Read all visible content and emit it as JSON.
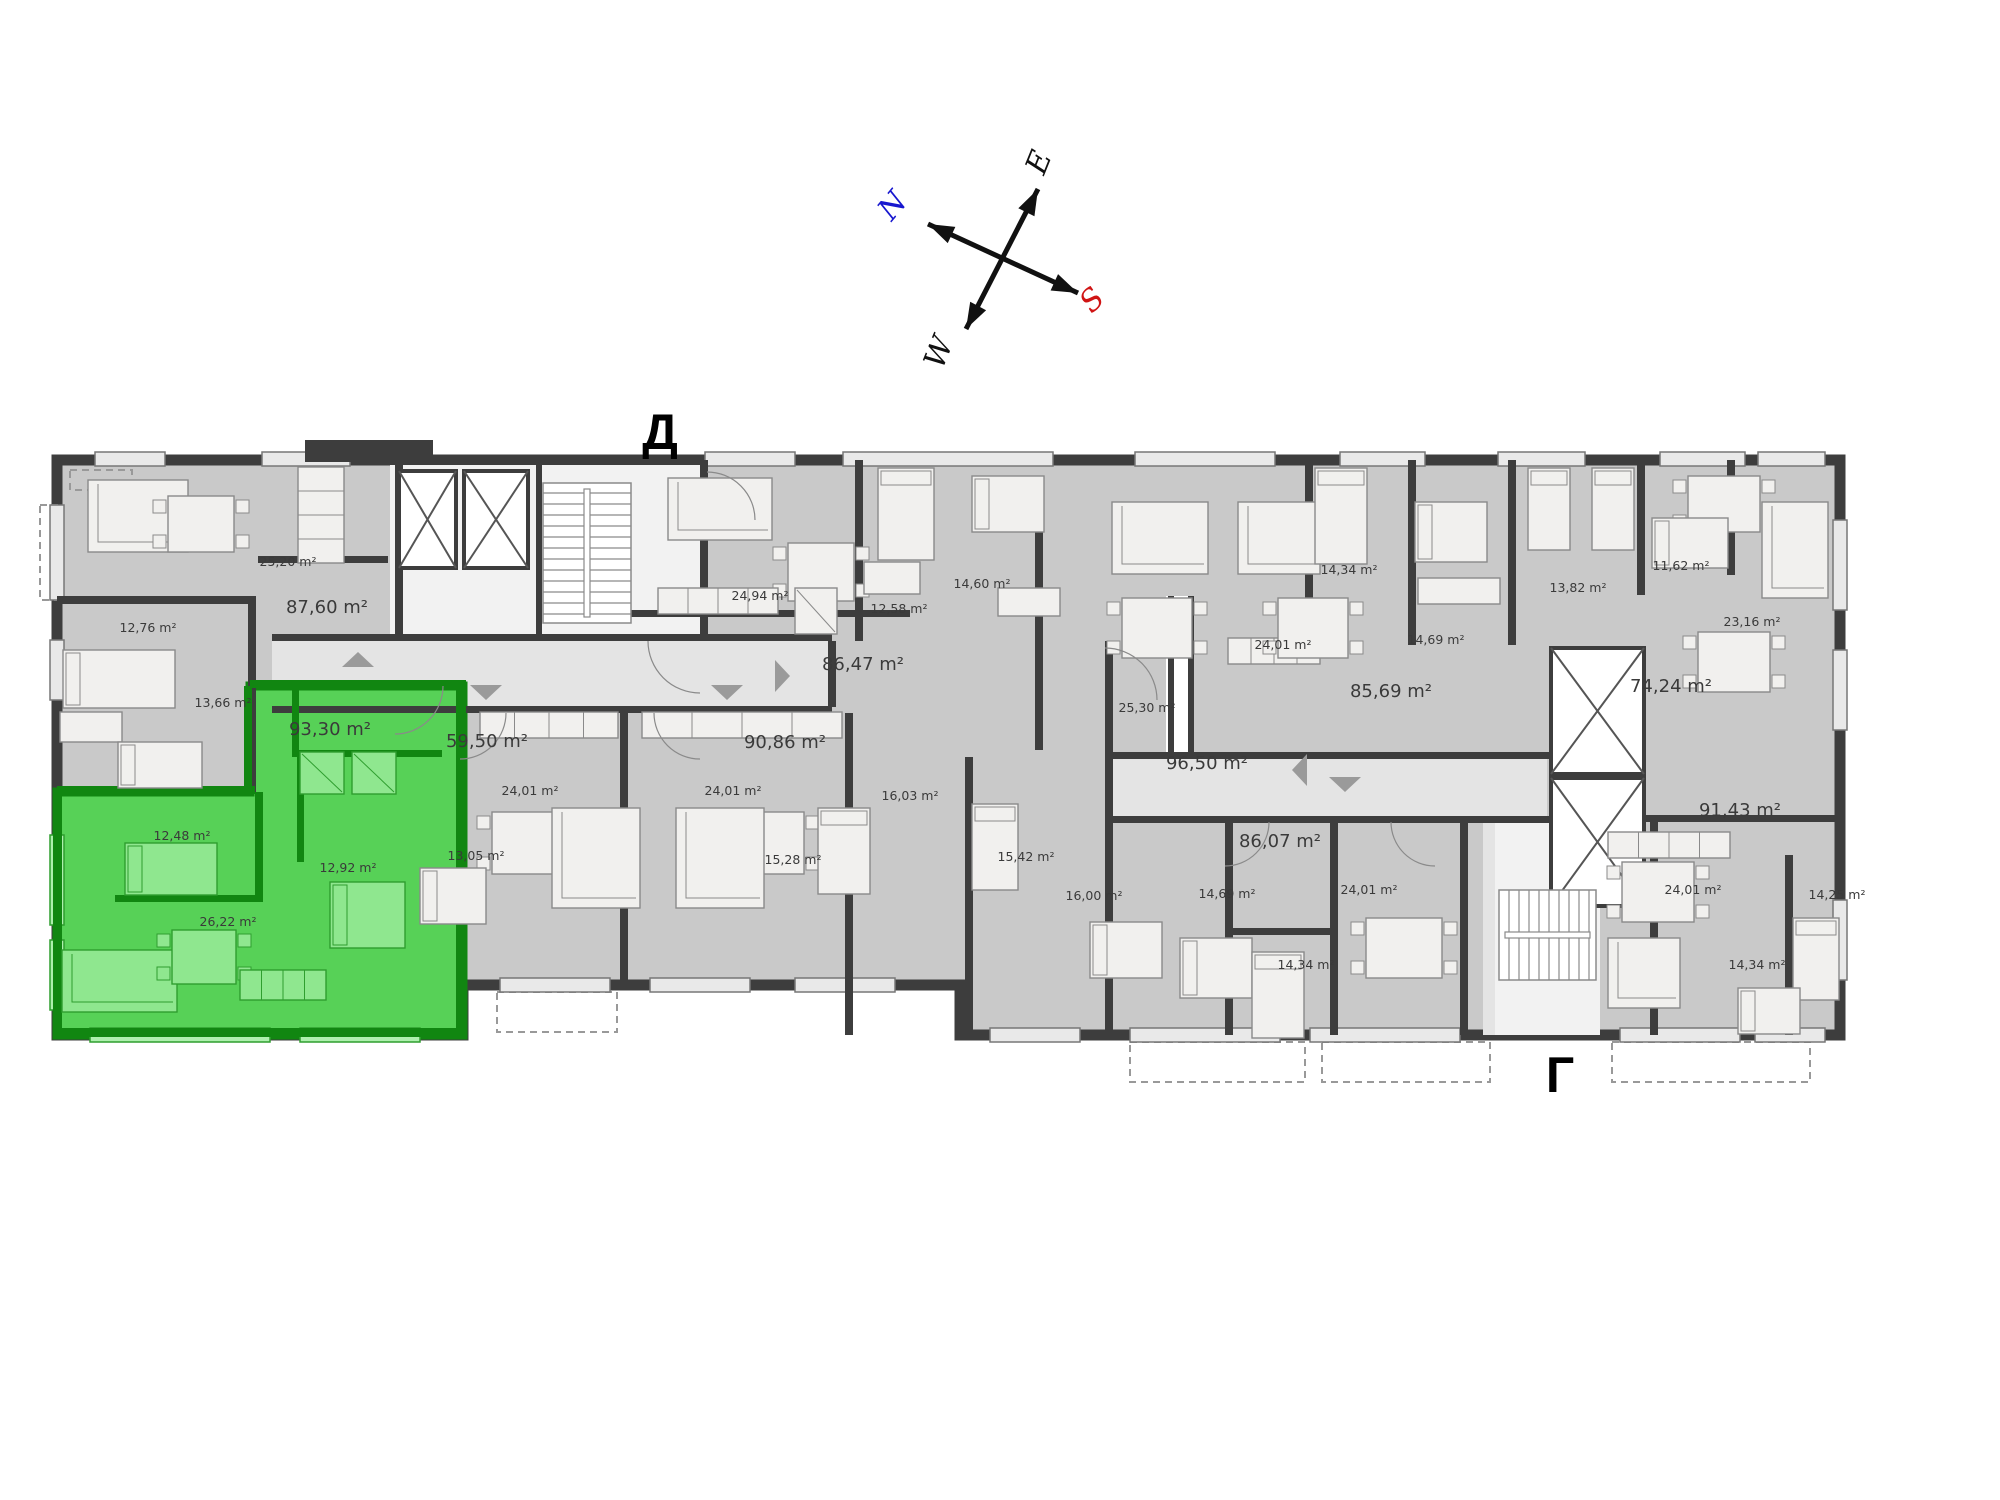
{
  "sections": {
    "d": "Д",
    "g": "Г"
  },
  "compass": {
    "center": [
      1003,
      259
    ],
    "lines": [
      [
        [
          928,
          224
        ],
        [
          1078,
          293
        ]
      ],
      [
        [
          1038,
          189
        ],
        [
          966,
          329
        ]
      ]
    ],
    "arms": [
      {
        "label": "N",
        "tip": [
          928,
          224
        ],
        "lx": 900,
        "ly": 212,
        "rot": -50,
        "color": "#1717cf"
      },
      {
        "label": "E",
        "tip": [
          1038,
          189
        ],
        "lx": 1048,
        "ly": 166,
        "rot": -68,
        "color": "#111111"
      },
      {
        "label": "S",
        "tip": [
          1078,
          293
        ],
        "lx": 1099,
        "ly": 307,
        "rot": -45,
        "color": "#d01414"
      },
      {
        "label": "W",
        "tip": [
          966,
          329
        ],
        "lx": 948,
        "ly": 356,
        "rot": -68,
        "color": "#111111"
      }
    ]
  },
  "palette": {
    "room": "#c9c9c9",
    "corridor": "#e4e4e4",
    "lobby": "#f2f2f2",
    "wall": "#3d3d3d",
    "window_fill": "#e9e9e9",
    "window_stroke": "#777777",
    "furn_fill": "#f1f0ee",
    "furn_stroke": "#8a8a8a",
    "green_fill": "#57d157",
    "green_wall": "#118611",
    "green_furn": "#8fe78f",
    "green_furn_stroke": "#2f9e2f",
    "green_window": "#aef0ae",
    "label": "#3a3a3a",
    "arrow": "#9a9a9a",
    "white": "#ffffff"
  },
  "plan": {
    "outline": [
      [
        57,
        460
      ],
      [
        1840,
        460
      ],
      [
        1840,
        1035
      ],
      [
        1105,
        1035
      ],
      [
        1105,
        1035
      ],
      [
        960,
        1035
      ],
      [
        960,
        985
      ],
      [
        463,
        985
      ],
      [
        463,
        1035
      ],
      [
        57,
        1035
      ]
    ],
    "corridors": [
      [
        272,
        641,
        558,
        66
      ],
      [
        1105,
        757,
        442,
        62
      ],
      [
        1483,
        819,
        64,
        216
      ]
    ],
    "lobbies": [
      [
        607,
        465,
        95,
        176
      ],
      [
        1495,
        822,
        105,
        213
      ],
      [
        390,
        465,
        250,
        176
      ]
    ],
    "seam": [
      1166,
      596,
      28,
      162
    ],
    "green_polygon": [
      [
        250,
        686
      ],
      [
        463,
        686
      ],
      [
        463,
        1035
      ],
      [
        57,
        1035
      ],
      [
        57,
        792
      ],
      [
        250,
        792
      ]
    ],
    "green_walls": [
      [
        250,
        680,
        216,
        8
      ],
      [
        57,
        786,
        198,
        8
      ],
      [
        244,
        686,
        8,
        106
      ],
      [
        456,
        686,
        10,
        349
      ],
      [
        292,
        686,
        7,
        70
      ],
      [
        292,
        750,
        150,
        7
      ],
      [
        255,
        792,
        8,
        110
      ],
      [
        115,
        895,
        148,
        7
      ],
      [
        297,
        757,
        7,
        105
      ],
      [
        53,
        792,
        9,
        243
      ],
      [
        53,
        1028,
        414,
        9
      ]
    ],
    "walls": [
      [
        248,
        596,
        8,
        196
      ],
      [
        395,
        460,
        8,
        181
      ],
      [
        536,
        460,
        6,
        181
      ],
      [
        700,
        460,
        8,
        181
      ],
      [
        855,
        460,
        8,
        181
      ],
      [
        1035,
        520,
        8,
        230
      ],
      [
        1105,
        641,
        8,
        394
      ],
      [
        1168,
        596,
        6,
        160
      ],
      [
        1188,
        596,
        6,
        160
      ],
      [
        1305,
        460,
        8,
        185
      ],
      [
        1408,
        460,
        8,
        185
      ],
      [
        1508,
        460,
        8,
        185
      ],
      [
        1637,
        460,
        8,
        135
      ],
      [
        1727,
        460,
        8,
        115
      ],
      [
        620,
        713,
        8,
        272
      ],
      [
        845,
        713,
        8,
        322
      ],
      [
        965,
        757,
        8,
        278
      ],
      [
        1225,
        822,
        8,
        213
      ],
      [
        1330,
        822,
        8,
        213
      ],
      [
        1460,
        822,
        8,
        213
      ],
      [
        1650,
        822,
        8,
        213
      ],
      [
        1785,
        855,
        8,
        180
      ],
      [
        57,
        596,
        195,
        8
      ],
      [
        258,
        556,
        130,
        7
      ],
      [
        272,
        634,
        560,
        7
      ],
      [
        272,
        706,
        560,
        7
      ],
      [
        828,
        641,
        8,
        66
      ],
      [
        630,
        610,
        280,
        7
      ],
      [
        1105,
        752,
        445,
        7
      ],
      [
        1105,
        816,
        445,
        7
      ],
      [
        1230,
        928,
        105,
        7
      ],
      [
        1645,
        815,
        195,
        7
      ],
      [
        305,
        440,
        128,
        22
      ]
    ],
    "windows": [
      [
        95,
        452,
        70,
        14
      ],
      [
        262,
        452,
        88,
        14
      ],
      [
        705,
        452,
        90,
        14
      ],
      [
        843,
        452,
        210,
        14
      ],
      [
        1135,
        452,
        140,
        14
      ],
      [
        1340,
        452,
        85,
        14
      ],
      [
        1498,
        452,
        87,
        14
      ],
      [
        1660,
        452,
        85,
        14
      ],
      [
        1758,
        452,
        67,
        14
      ],
      [
        50,
        505,
        14,
        95
      ],
      [
        50,
        640,
        14,
        60
      ],
      [
        500,
        978,
        110,
        14
      ],
      [
        650,
        978,
        100,
        14
      ],
      [
        795,
        978,
        100,
        14
      ],
      [
        990,
        1028,
        90,
        14
      ],
      [
        1130,
        1028,
        150,
        14
      ],
      [
        1310,
        1028,
        150,
        14
      ],
      [
        1620,
        1028,
        120,
        14
      ],
      [
        1755,
        1028,
        70,
        14
      ],
      [
        1833,
        520,
        14,
        90
      ],
      [
        1833,
        650,
        14,
        80
      ],
      [
        1833,
        900,
        14,
        80
      ]
    ],
    "green_windows": [
      [
        90,
        1028,
        180,
        14
      ],
      [
        300,
        1028,
        120,
        14
      ],
      [
        50,
        835,
        14,
        90
      ],
      [
        50,
        940,
        14,
        70
      ]
    ],
    "balconies": [
      [
        497,
        992,
        120,
        40
      ],
      [
        1130,
        1042,
        175,
        40
      ],
      [
        1322,
        1042,
        168,
        40
      ],
      [
        1612,
        1042,
        198,
        40
      ],
      [
        40,
        505,
        17,
        95
      ],
      [
        70,
        470,
        62,
        20
      ]
    ],
    "cores": [
      [
        399,
        471,
        57,
        97
      ],
      [
        464,
        471,
        64,
        97
      ],
      [
        1551,
        648,
        93,
        126
      ],
      [
        1551,
        778,
        93,
        128
      ]
    ],
    "stairs": [
      {
        "rect": [
          543,
          483,
          88,
          140
        ],
        "dir": "v"
      },
      {
        "rect": [
          1499,
          890,
          97,
          90
        ],
        "dir": "h"
      }
    ],
    "furniture": [
      {
        "k": "sofa",
        "r": [
          88,
          480,
          100,
          72
        ]
      },
      {
        "k": "table",
        "r": [
          168,
          496,
          66,
          56
        ]
      },
      {
        "k": "counter",
        "r": [
          298,
          467,
          46,
          96
        ]
      },
      {
        "k": "bed",
        "r": [
          63,
          650,
          112,
          58
        ]
      },
      {
        "k": "desk",
        "r": [
          60,
          712,
          62,
          30
        ]
      },
      {
        "k": "bed",
        "r": [
          118,
          742,
          84,
          46
        ]
      },
      {
        "k": "bed",
        "r": [
          125,
          843,
          92,
          52
        ],
        "g": 1
      },
      {
        "k": "bed",
        "r": [
          330,
          882,
          75,
          66
        ],
        "g": 1
      },
      {
        "k": "sofa",
        "r": [
          62,
          950,
          115,
          62
        ],
        "g": 1
      },
      {
        "k": "table",
        "r": [
          172,
          930,
          64,
          54
        ],
        "g": 1
      },
      {
        "k": "counter",
        "r": [
          240,
          970,
          86,
          30
        ],
        "g": 1
      },
      {
        "k": "shower",
        "r": [
          300,
          752,
          44,
          42
        ],
        "g": 1
      },
      {
        "k": "shower",
        "r": [
          352,
          752,
          44,
          42
        ],
        "g": 1
      },
      {
        "k": "sofa",
        "r": [
          668,
          478,
          104,
          62
        ]
      },
      {
        "k": "table",
        "r": [
          788,
          543,
          66,
          58
        ]
      },
      {
        "k": "counter",
        "r": [
          658,
          588,
          120,
          26
        ]
      },
      {
        "k": "bed",
        "r": [
          878,
          468,
          56,
          92
        ]
      },
      {
        "k": "desk",
        "r": [
          864,
          562,
          56,
          32
        ]
      },
      {
        "k": "bed",
        "r": [
          972,
          476,
          72,
          56
        ]
      },
      {
        "k": "wardrobe",
        "r": [
          998,
          588,
          62,
          28
        ]
      },
      {
        "k": "sofa",
        "r": [
          1112,
          502,
          96,
          72
        ]
      },
      {
        "k": "table",
        "r": [
          1122,
          598,
          70,
          60
        ]
      },
      {
        "k": "counter",
        "r": [
          1228,
          638,
          92,
          26
        ]
      },
      {
        "k": "sofa",
        "r": [
          1238,
          502,
          82,
          72
        ]
      },
      {
        "k": "table",
        "r": [
          1278,
          598,
          70,
          60
        ]
      },
      {
        "k": "bed",
        "r": [
          1315,
          468,
          52,
          96
        ]
      },
      {
        "k": "bed",
        "r": [
          1415,
          502,
          72,
          60
        ]
      },
      {
        "k": "wardrobe",
        "r": [
          1418,
          578,
          82,
          26
        ]
      },
      {
        "k": "bed",
        "r": [
          1528,
          468,
          42,
          82
        ]
      },
      {
        "k": "bed",
        "r": [
          1592,
          468,
          42,
          82
        ]
      },
      {
        "k": "table",
        "r": [
          1688,
          476,
          72,
          56
        ]
      },
      {
        "k": "bed",
        "r": [
          1652,
          518,
          76,
          50
        ]
      },
      {
        "k": "sofa",
        "r": [
          1762,
          502,
          66,
          96
        ]
      },
      {
        "k": "table",
        "r": [
          1698,
          632,
          72,
          60
        ]
      },
      {
        "k": "shower",
        "r": [
          795,
          588,
          42,
          46
        ]
      },
      {
        "k": "counter",
        "r": [
          480,
          712,
          138,
          26
        ]
      },
      {
        "k": "counter",
        "r": [
          642,
          712,
          200,
          26
        ]
      },
      {
        "k": "table",
        "r": [
          492,
          812,
          72,
          62
        ]
      },
      {
        "k": "sofa",
        "r": [
          552,
          808,
          88,
          100
        ]
      },
      {
        "k": "table",
        "r": [
          732,
          812,
          72,
          62
        ]
      },
      {
        "k": "sofa",
        "r": [
          676,
          808,
          88,
          100
        ]
      },
      {
        "k": "bed",
        "r": [
          420,
          868,
          66,
          56
        ]
      },
      {
        "k": "bed",
        "r": [
          818,
          808,
          52,
          86
        ]
      },
      {
        "k": "bed",
        "r": [
          972,
          804,
          46,
          86
        ]
      },
      {
        "k": "bed",
        "r": [
          1090,
          922,
          72,
          56
        ]
      },
      {
        "k": "bed",
        "r": [
          1180,
          938,
          72,
          60
        ]
      },
      {
        "k": "table",
        "r": [
          1366,
          918,
          76,
          60
        ]
      },
      {
        "k": "bed",
        "r": [
          1252,
          952,
          52,
          86
        ]
      },
      {
        "k": "counter",
        "r": [
          1608,
          832,
          122,
          26
        ]
      },
      {
        "k": "table",
        "r": [
          1622,
          862,
          72,
          60
        ]
      },
      {
        "k": "sofa",
        "r": [
          1608,
          938,
          72,
          70
        ]
      },
      {
        "k": "bed",
        "r": [
          1793,
          918,
          46,
          82
        ]
      },
      {
        "k": "bed",
        "r": [
          1738,
          988,
          62,
          46
        ]
      }
    ],
    "arcs": [
      {
        "cx": 460,
        "cy": 713,
        "r": 46,
        "a0": 0,
        "a1": 90
      },
      {
        "cx": 700,
        "cy": 713,
        "r": 46,
        "a0": 90,
        "a1": 180
      },
      {
        "cx": 700,
        "cy": 641,
        "r": 52,
        "a0": 90,
        "a1": 180
      },
      {
        "cx": 395,
        "cy": 686,
        "r": 48,
        "a0": 0,
        "a1": 90
      },
      {
        "cx": 1225,
        "cy": 822,
        "r": 44,
        "a0": 0,
        "a1": 90
      },
      {
        "cx": 1435,
        "cy": 822,
        "r": 44,
        "a0": 90,
        "a1": 180
      },
      {
        "cx": 707,
        "cy": 520,
        "r": 48,
        "a0": 270,
        "a1": 360
      },
      {
        "cx": 1105,
        "cy": 700,
        "r": 52,
        "a0": 270,
        "a1": 360
      }
    ],
    "arrows": [
      {
        "x": 486,
        "y": 700,
        "dir": "down"
      },
      {
        "x": 727,
        "y": 700,
        "dir": "down"
      },
      {
        "x": 358,
        "y": 652,
        "dir": "up"
      },
      {
        "x": 790,
        "y": 676,
        "dir": "right"
      },
      {
        "x": 1345,
        "y": 792,
        "dir": "down"
      },
      {
        "x": 1292,
        "y": 770,
        "dir": "left"
      }
    ],
    "area_labels": [
      {
        "t": "25,20 m²",
        "x": 288,
        "y": 566
      },
      {
        "t": "87,60 m²",
        "x": 327,
        "y": 613,
        "big": 1
      },
      {
        "t": "12,76 m²",
        "x": 148,
        "y": 632
      },
      {
        "t": "13,66 m²",
        "x": 223,
        "y": 707
      },
      {
        "t": "93,30 m²",
        "x": 330,
        "y": 735,
        "big": 1,
        "g": 1
      },
      {
        "t": "12,48 m²",
        "x": 182,
        "y": 840,
        "g": 1
      },
      {
        "t": "12,92 m²",
        "x": 348,
        "y": 872,
        "g": 1
      },
      {
        "t": "26,22 m²",
        "x": 228,
        "y": 926,
        "g": 1
      },
      {
        "t": "24,94 m²",
        "x": 760,
        "y": 600
      },
      {
        "t": "86,47 m²",
        "x": 863,
        "y": 670,
        "big": 1
      },
      {
        "t": "59,50 m²",
        "x": 487,
        "y": 747,
        "big": 1
      },
      {
        "t": "90,86 m²",
        "x": 785,
        "y": 748,
        "big": 1
      },
      {
        "t": "24,01 m²",
        "x": 530,
        "y": 795
      },
      {
        "t": "24,01 m²",
        "x": 733,
        "y": 795
      },
      {
        "t": "12,58 m²",
        "x": 899,
        "y": 613
      },
      {
        "t": "14,60 m²",
        "x": 982,
        "y": 588
      },
      {
        "t": "25,30 m²",
        "x": 1147,
        "y": 712
      },
      {
        "t": "96,50 m²",
        "x": 1207,
        "y": 769,
        "big": 1
      },
      {
        "t": "16,03 m²",
        "x": 910,
        "y": 800
      },
      {
        "t": "14,34 m²",
        "x": 1349,
        "y": 574
      },
      {
        "t": "13,82 m²",
        "x": 1578,
        "y": 592
      },
      {
        "t": "24,01 m²",
        "x": 1283,
        "y": 649
      },
      {
        "t": "14,69 m²",
        "x": 1436,
        "y": 644
      },
      {
        "t": "85,69 m²",
        "x": 1391,
        "y": 697,
        "big": 1
      },
      {
        "t": "11,62 m²",
        "x": 1681,
        "y": 570
      },
      {
        "t": "23,16 m²",
        "x": 1752,
        "y": 626
      },
      {
        "t": "74,24 m²",
        "x": 1671,
        "y": 692,
        "big": 1
      },
      {
        "t": "91,43 m²",
        "x": 1740,
        "y": 816,
        "big": 1
      },
      {
        "t": "13,05 m²",
        "x": 476,
        "y": 860
      },
      {
        "t": "15,28 m²",
        "x": 793,
        "y": 864
      },
      {
        "t": "15,42 m²",
        "x": 1026,
        "y": 861
      },
      {
        "t": "16,00 m²",
        "x": 1094,
        "y": 900
      },
      {
        "t": "14,69 m²",
        "x": 1227,
        "y": 898
      },
      {
        "t": "86,07 m²",
        "x": 1280,
        "y": 847,
        "big": 1
      },
      {
        "t": "24,01 m²",
        "x": 1369,
        "y": 894
      },
      {
        "t": "14,34 m²",
        "x": 1306,
        "y": 969
      },
      {
        "t": "24,01 m²",
        "x": 1693,
        "y": 894
      },
      {
        "t": "14,25 m²",
        "x": 1837,
        "y": 899
      },
      {
        "t": "14,34 m²",
        "x": 1757,
        "y": 969
      }
    ]
  }
}
